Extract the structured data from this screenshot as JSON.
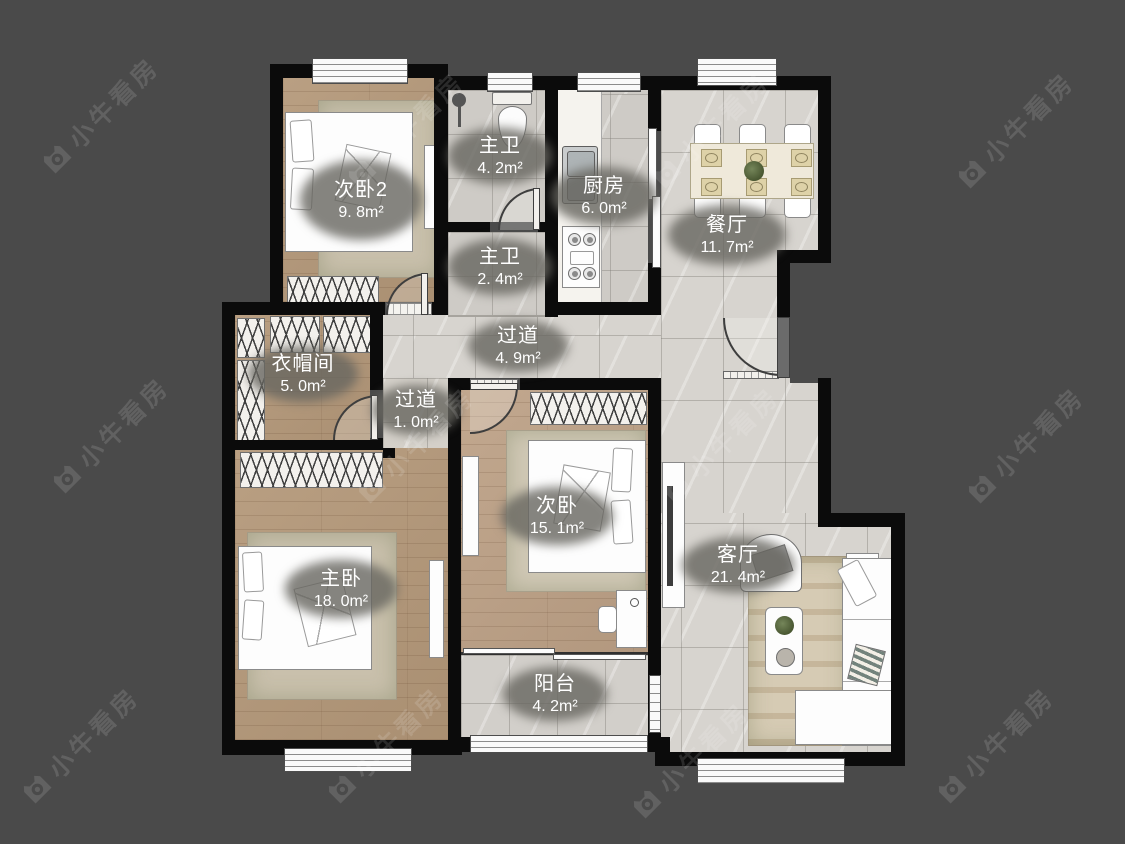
{
  "watermark": {
    "text": "小牛看房"
  },
  "rooms": [
    {
      "id": "bedroom2",
      "name": "次卧2",
      "area": "9. 8m²"
    },
    {
      "id": "bath_master",
      "name": "主卫",
      "area": "4. 2m²"
    },
    {
      "id": "kitchen",
      "name": "厨房",
      "area": "6. 0m²"
    },
    {
      "id": "dining",
      "name": "餐厅",
      "area": "11. 7m²"
    },
    {
      "id": "bath_second",
      "name": "主卫",
      "area": "2. 4m²"
    },
    {
      "id": "hallway",
      "name": "过道",
      "area": "4. 9m²"
    },
    {
      "id": "cloakroom",
      "name": "衣帽间",
      "area": "5. 0m²"
    },
    {
      "id": "hallway_small",
      "name": "过道",
      "area": "1. 0m²"
    },
    {
      "id": "bedroom_second",
      "name": "次卧",
      "area": "15. 1m²"
    },
    {
      "id": "bedroom_master",
      "name": "主卧",
      "area": "18. 0m²"
    },
    {
      "id": "living",
      "name": "客厅",
      "area": "21. 4m²"
    },
    {
      "id": "balcony",
      "name": "阳台",
      "area": "4. 2m²"
    }
  ],
  "colors": {
    "background": "#4a4a4a",
    "wall": "#0b0b0b",
    "tile_floor": "#d7d4cf",
    "wood_floor": "#b49879",
    "label_bg": "#67655f",
    "label_text": "#ffffff"
  }
}
